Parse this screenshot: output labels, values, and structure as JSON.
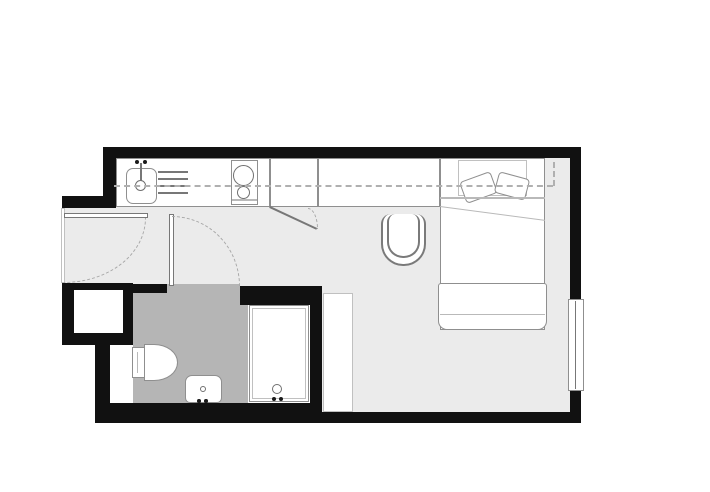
{
  "meta": {
    "title": "Studio apartment floor plan",
    "description": "Black-wall architectural plan: kitchen strip with sink and two-burner hob, tall cabinet, desk with chair, double bed with pillows and foot bench, entry door, bathroom with grey floor containing toilet, washbasin and shower, window on right wall"
  },
  "palette": {
    "wall": "#111111",
    "main_floor": "#ebebeb",
    "bath_floor": "#b5b5b5",
    "fixture_outline": "#8f8f8f",
    "dashed_guides": "#b0b0b0",
    "background": "#ffffff"
  },
  "plan": {
    "w": 710,
    "h": 492,
    "items": [
      {
        "n": "floor-kitchen-hall",
        "t": "floor",
        "x": 116,
        "y": 158,
        "w": 454,
        "h": 128
      },
      {
        "n": "floor-entry-nook",
        "t": "floor",
        "x": 62,
        "y": 208,
        "w": 54,
        "h": 78
      },
      {
        "n": "floor-living",
        "t": "floor",
        "x": 322,
        "y": 286,
        "w": 248,
        "h": 126
      },
      {
        "n": "floor-bathroom",
        "t": "bath",
        "x": 133,
        "y": 292,
        "w": 115,
        "h": 111
      },
      {
        "n": "floor-bathroom-doorway",
        "t": "bath",
        "x": 167,
        "y": 284,
        "w": 73,
        "h": 9
      },
      {
        "n": "wall-top",
        "t": "wall",
        "x": 103,
        "y": 147,
        "w": 478,
        "h": 11
      },
      {
        "n": "wall-right-upper",
        "t": "wall",
        "x": 570,
        "y": 147,
        "w": 11,
        "h": 154
      },
      {
        "n": "wall-right-lower",
        "t": "wall",
        "x": 570,
        "y": 390,
        "w": 11,
        "h": 33
      },
      {
        "n": "wall-bottom-main",
        "t": "wall",
        "x": 310,
        "y": 412,
        "w": 271,
        "h": 11
      },
      {
        "n": "wall-bottom-bath",
        "t": "wall",
        "x": 95,
        "y": 403,
        "w": 227,
        "h": 20
      },
      {
        "n": "wall-kitchen-left",
        "t": "wall",
        "x": 103,
        "y": 147,
        "w": 13,
        "h": 61
      },
      {
        "n": "wall-entry-head",
        "t": "wall",
        "x": 62,
        "y": 196,
        "w": 54,
        "h": 12
      },
      {
        "n": "wall-bath-left-block",
        "t": "wall",
        "x": 62,
        "y": 283,
        "w": 71,
        "h": 62
      },
      {
        "n": "wall-left-column",
        "t": "wall",
        "x": 95,
        "y": 345,
        "w": 15,
        "h": 60
      },
      {
        "n": "wall-bath-top-left",
        "t": "wall",
        "x": 133,
        "y": 284,
        "w": 34,
        "h": 9
      },
      {
        "n": "wall-shower-top",
        "t": "wall",
        "x": 240,
        "y": 286,
        "w": 82,
        "h": 19
      },
      {
        "n": "wall-shower-right",
        "t": "wall",
        "x": 310,
        "y": 286,
        "w": 12,
        "h": 117
      },
      {
        "n": "wall-shaft-niche",
        "t": "white",
        "x": 74,
        "y": 290,
        "w": 49,
        "h": 43
      },
      {
        "n": "wall-recess-lower",
        "t": "white",
        "x": 110,
        "y": 345,
        "w": 23,
        "h": 58
      },
      {
        "n": "kitchen-counter",
        "t": "box",
        "x": 116,
        "y": 158,
        "w": 154,
        "h": 49
      },
      {
        "n": "tall-cabinet",
        "t": "box",
        "x": 270,
        "y": 158,
        "w": 48,
        "h": 49
      },
      {
        "n": "desk-counter",
        "t": "box",
        "x": 318,
        "y": 158,
        "w": 122,
        "h": 49
      },
      {
        "n": "kitchen-sink",
        "t": "box",
        "x": 126,
        "y": 168,
        "w": 31,
        "h": 36,
        "r": "7px"
      },
      {
        "n": "sink-drainer-line-1",
        "t": "line",
        "x": 158,
        "y": 171,
        "w": 30,
        "h": 1.5
      },
      {
        "n": "sink-drainer-line-2",
        "t": "line",
        "x": 158,
        "y": 178,
        "w": 30,
        "h": 1.5
      },
      {
        "n": "sink-drainer-line-3",
        "t": "line",
        "x": 158,
        "y": 185,
        "w": 30,
        "h": 1.5
      },
      {
        "n": "sink-drainer-line-4",
        "t": "line",
        "x": 158,
        "y": 192,
        "w": 30,
        "h": 1.5
      },
      {
        "n": "stove",
        "t": "box",
        "x": 231,
        "y": 160,
        "w": 27,
        "h": 45
      },
      {
        "n": "stove-base-line",
        "t": "linel",
        "x": 232,
        "y": 199,
        "w": 25,
        "h": 1.5
      },
      {
        "n": "stove-burner-large",
        "t": "circle",
        "x": 233,
        "y": 165,
        "w": 21,
        "h": 21
      },
      {
        "n": "stove-burner-small",
        "t": "circle",
        "x": 237,
        "y": 186,
        "w": 13,
        "h": 13
      },
      {
        "n": "sink-faucet-stem",
        "t": "line",
        "x": 140,
        "y": 163,
        "w": 1.5,
        "h": 19
      },
      {
        "n": "sink-faucet-knob-left",
        "t": "dot",
        "x": 135,
        "y": 160,
        "w": 4,
        "h": 4
      },
      {
        "n": "sink-faucet-knob-right",
        "t": "dot",
        "x": 143,
        "y": 160,
        "w": 4,
        "h": 4
      },
      {
        "n": "sink-faucet-circle",
        "t": "circle",
        "x": 135,
        "y": 180,
        "w": 11,
        "h": 11
      },
      {
        "n": "cabinet-door-open",
        "t": "line",
        "x": 270,
        "y": 206,
        "w": 52,
        "h": 2,
        "rot": 25,
        "o": "0"
      },
      {
        "n": "cabinet-door-swing-arc",
        "t": "arc-tr",
        "x": 308,
        "y": 208,
        "w": 10,
        "h": 21
      },
      {
        "n": "desk-chair",
        "t": "ubox",
        "x": 381,
        "y": 214,
        "w": 45,
        "h": 52,
        "r": "10px 10px 22px 22px"
      },
      {
        "n": "desk-chair-inner",
        "t": "ubox",
        "x": 387,
        "y": 214,
        "w": 33,
        "h": 44,
        "r": "8px 8px 16px 16px"
      },
      {
        "n": "bed",
        "t": "box",
        "x": 440,
        "y": 158,
        "w": 105,
        "h": 172
      },
      {
        "n": "bed-headboard-zone",
        "t": "boxl",
        "x": 458,
        "y": 160,
        "w": 69,
        "h": 36
      },
      {
        "n": "bed-pillow-left",
        "t": "box",
        "x": 462,
        "y": 176,
        "w": 33,
        "h": 23,
        "r": "4px",
        "rot": -20,
        "o": "c"
      },
      {
        "n": "bed-pillow-right",
        "t": "box",
        "x": 496,
        "y": 175,
        "w": 32,
        "h": 22,
        "r": "4px",
        "rot": 15,
        "o": "c"
      },
      {
        "n": "bed-blanket-edge",
        "t": "linel",
        "x": 440,
        "y": 197,
        "w": 105,
        "h": 1.5
      },
      {
        "n": "bed-blanket-fold",
        "t": "linel",
        "x": 440,
        "y": 206,
        "w": 106,
        "h": 1.2,
        "rot": 7.5,
        "o": "0"
      },
      {
        "n": "bed-foot-bench",
        "t": "box",
        "x": 438,
        "y": 283,
        "w": 109,
        "h": 47,
        "r": "3px 3px 9px 9px"
      },
      {
        "n": "bed-foot-bench-line",
        "t": "linel",
        "x": 440,
        "y": 314,
        "w": 105,
        "h": 1.2
      },
      {
        "n": "bathroom-side-cabinet",
        "t": "boxl",
        "x": 323,
        "y": 293,
        "w": 30,
        "h": 119
      },
      {
        "n": "toilet-tank",
        "t": "box",
        "x": 132,
        "y": 347,
        "w": 13,
        "h": 31
      },
      {
        "n": "toilet-bowl",
        "t": "box",
        "x": 144,
        "y": 344,
        "w": 34,
        "h": 37,
        "r": "0 70% 70% 0 / 0 50% 50% 0"
      },
      {
        "n": "toilet-tank-line",
        "t": "linel",
        "x": 137,
        "y": 352,
        "w": 1.2,
        "h": 21
      },
      {
        "n": "washbasin",
        "t": "box",
        "x": 185,
        "y": 375,
        "w": 37,
        "h": 28,
        "r": "7px 7px 5px 5px"
      },
      {
        "n": "washbasin-drain",
        "t": "circle",
        "x": 200,
        "y": 386,
        "w": 6,
        "h": 6
      },
      {
        "n": "washbasin-tap-left",
        "t": "dot",
        "x": 197,
        "y": 399,
        "w": 3.5,
        "h": 3.5
      },
      {
        "n": "washbasin-tap-right",
        "t": "dot",
        "x": 204,
        "y": 399,
        "w": 3.5,
        "h": 3.5
      },
      {
        "n": "shower-tray",
        "t": "box",
        "x": 249,
        "y": 305,
        "w": 60,
        "h": 97
      },
      {
        "n": "shower-tray-inner",
        "t": "boxl",
        "x": 252,
        "y": 308,
        "w": 54,
        "h": 91
      },
      {
        "n": "shower-drain",
        "t": "circle",
        "x": 272,
        "y": 384,
        "w": 10,
        "h": 10
      },
      {
        "n": "shower-knob-left",
        "t": "dot",
        "x": 272,
        "y": 397,
        "w": 4,
        "h": 4
      },
      {
        "n": "shower-knob-right",
        "t": "dot",
        "x": 279,
        "y": 397,
        "w": 4,
        "h": 4
      },
      {
        "n": "window-right",
        "t": "box",
        "x": 568,
        "y": 299,
        "w": 16,
        "h": 92
      },
      {
        "n": "window-glazing-line",
        "t": "line",
        "x": 575,
        "y": 301,
        "w": 1,
        "h": 88
      },
      {
        "n": "overhead-cabinet-dashed-line",
        "t": "dash-h",
        "x": 114,
        "y": 185,
        "w": 439,
        "h": 0
      },
      {
        "n": "overhead-cabinet-dashed-end",
        "t": "dash-v",
        "x": 553,
        "y": 162,
        "w": 0,
        "h": 24
      },
      {
        "n": "entry-threshold",
        "t": "boxl",
        "x": 61,
        "y": 208,
        "w": 4,
        "h": 75
      },
      {
        "n": "entry-door-leaf",
        "t": "leaf",
        "x": 64,
        "y": 213,
        "w": 84,
        "h": 5
      },
      {
        "n": "entry-door-swing-arc",
        "t": "arc-br",
        "x": 64,
        "y": 218,
        "w": 82,
        "h": 65
      },
      {
        "n": "bathroom-door-leaf",
        "t": "leaf",
        "x": 169,
        "y": 214,
        "w": 5,
        "h": 72
      },
      {
        "n": "bathroom-door-swing-arc",
        "t": "arc-tr",
        "x": 172,
        "y": 216,
        "w": 68,
        "h": 70
      }
    ]
  }
}
